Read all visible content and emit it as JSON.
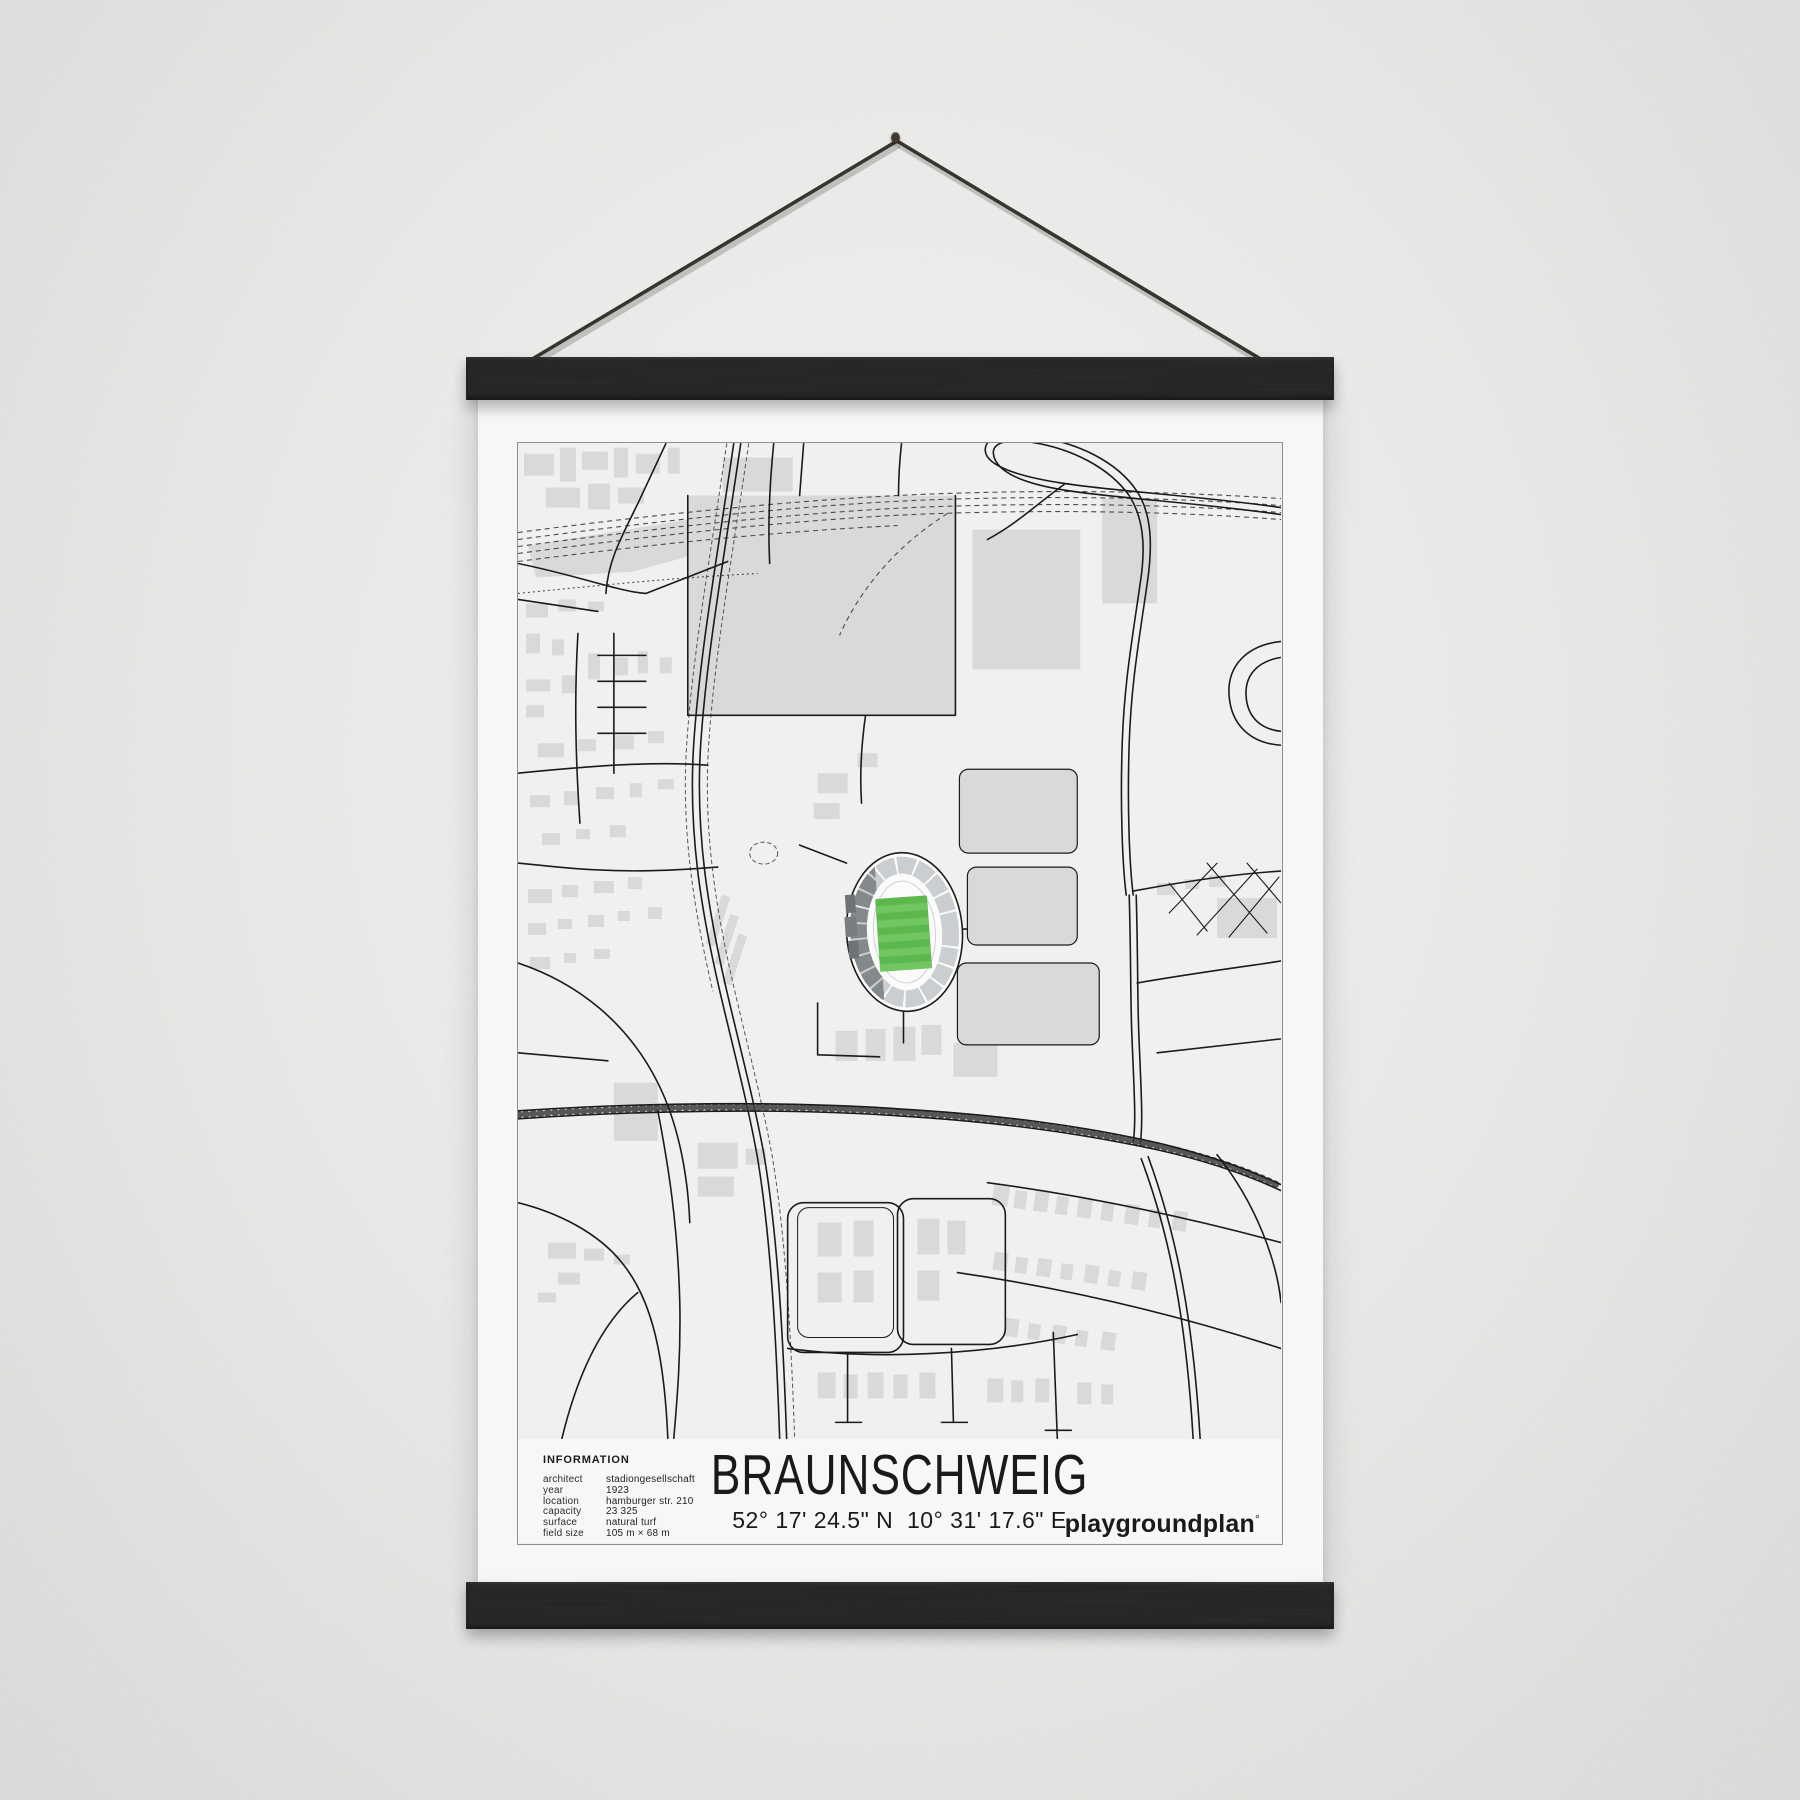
{
  "poster": {
    "title": "BRAUNSCHWEIG",
    "coordinates": "52° 17' 24.5\" N  10° 31' 17.6\" E",
    "brand": "playgroundplan",
    "brand_mark": "°",
    "info": {
      "heading": "INFORMATION",
      "rows": [
        {
          "label": "architect",
          "value": "stadiongesellschaft"
        },
        {
          "label": "year",
          "value": "1923"
        },
        {
          "label": "location",
          "value": "hamburger str. 210"
        },
        {
          "label": "capacity",
          "value": "23 325"
        },
        {
          "label": "surface",
          "value": "natural turf"
        },
        {
          "label": "field size",
          "value": "105 m × 68 m"
        }
      ]
    }
  },
  "colors": {
    "wall": "#e9e9e7",
    "paper": "#f7f7f6",
    "bar": "#2d2b2a",
    "string": "#38342f",
    "frame": "#8f8f8f",
    "map_bg": "#f0f0ee",
    "building": "#d7d9da",
    "road": "#1b1b1b",
    "rail": "#4b4b4b",
    "pitch_green": "#5cb84c",
    "pitch_stripe": "#72c662",
    "stand_light": "#cbced0",
    "stand_dark": "#84898c",
    "text": "#1a1a1a"
  }
}
